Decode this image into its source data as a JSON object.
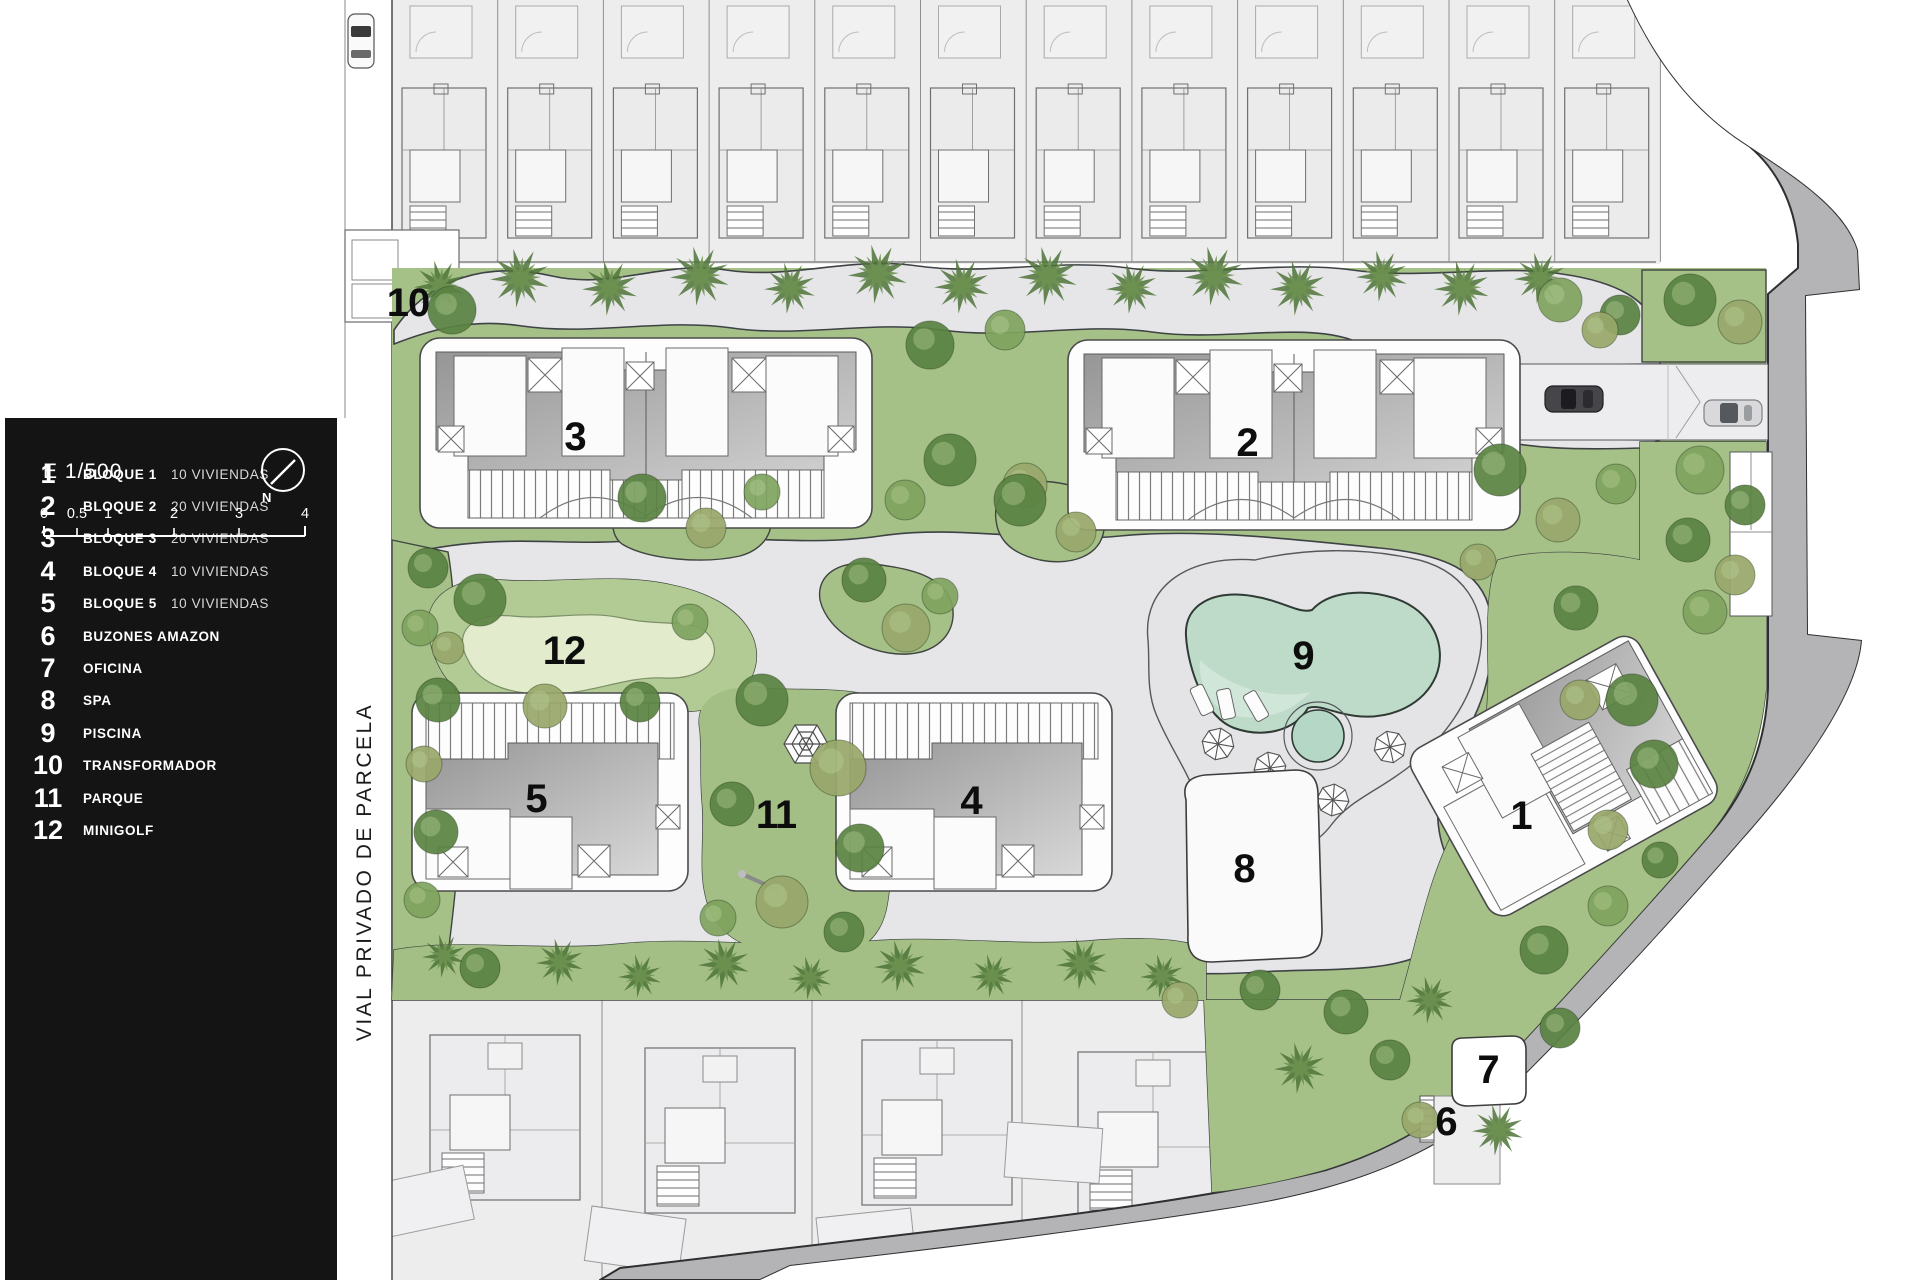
{
  "legend": {
    "items": [
      {
        "num": "1",
        "label": "BLOQUE 1",
        "detail": "10 VIVIENDAS"
      },
      {
        "num": "2",
        "label": "BLOQUE 2",
        "detail": "20 VIVIENDAS"
      },
      {
        "num": "3",
        "label": "BLOQUE 3",
        "detail": "20 VIVIENDAS"
      },
      {
        "num": "4",
        "label": "BLOQUE 4",
        "detail": "10 VIVIENDAS"
      },
      {
        "num": "5",
        "label": "BLOQUE 5",
        "detail": "10 VIVIENDAS"
      },
      {
        "num": "6",
        "label": "BUZONES AMAZON",
        "detail": ""
      },
      {
        "num": "7",
        "label": "OFICINA",
        "detail": ""
      },
      {
        "num": "8",
        "label": "SPA",
        "detail": ""
      },
      {
        "num": "9",
        "label": "PISCINA",
        "detail": ""
      },
      {
        "num": "10",
        "label": "TRANSFORMADOR",
        "detail": ""
      },
      {
        "num": "11",
        "label": "PARQUE",
        "detail": ""
      },
      {
        "num": "12",
        "label": "MINIGOLF",
        "detail": ""
      }
    ]
  },
  "scale": {
    "label": "E 1/500",
    "north": "N",
    "ticks": [
      "0",
      "0.5",
      "1",
      "2",
      "3",
      "4"
    ]
  },
  "plan": {
    "street": "VIAL PRIVADO DE PARCELA",
    "markers": {
      "m1": "1",
      "m2": "2",
      "m3": "3",
      "m4": "4",
      "m5": "5",
      "m6": "6",
      "m7": "7",
      "m8": "8",
      "m9": "9",
      "m10": "10",
      "m11": "11",
      "m12": "12"
    }
  }
}
